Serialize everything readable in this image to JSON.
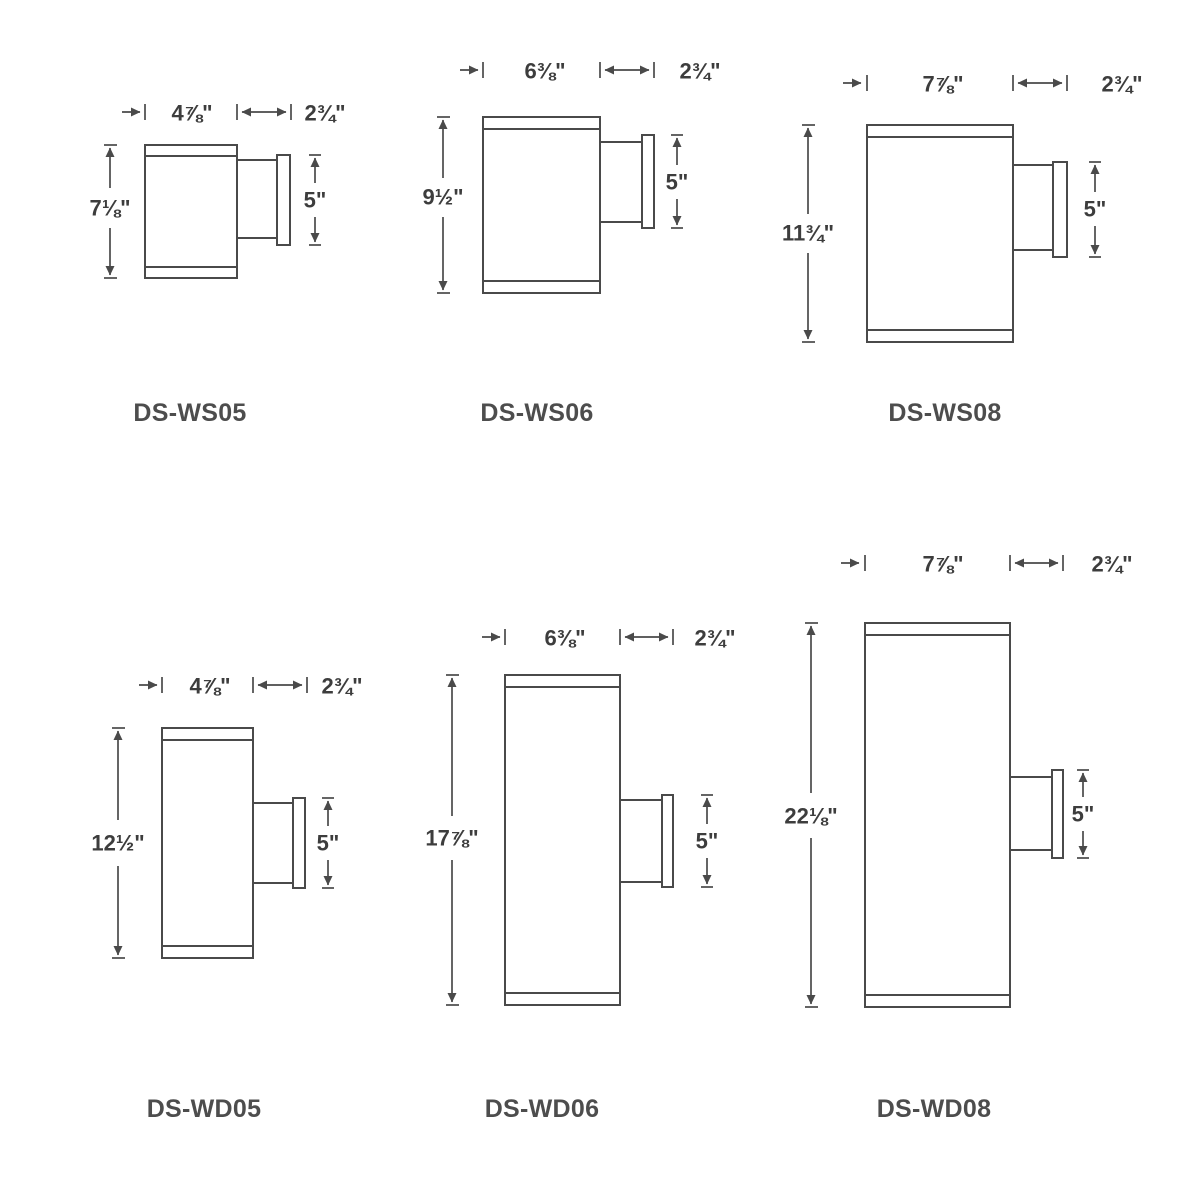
{
  "sheet": {
    "description_rows": [
      "single wall sconces",
      "double wall sconces"
    ],
    "colors": {
      "line": "#4a4a4a",
      "dimension_text": "#3d3d3d",
      "model_text": "#4d4d4d",
      "background": "#ffffff"
    }
  },
  "diagrams": [
    {
      "model": "DS-WS05",
      "width": "4⅞\"",
      "depth": "2¾\"",
      "height": "7⅛\"",
      "backplate": "5\""
    },
    {
      "model": "DS-WS06",
      "width": "6⅜\"",
      "depth": "2¾\"",
      "height": "9½\"",
      "backplate": "5\""
    },
    {
      "model": "DS-WS08",
      "width": "7⅞\"",
      "depth": "2¾\"",
      "height": "11¾\"",
      "backplate": "5\""
    },
    {
      "model": "DS-WD05",
      "width": "4⅞\"",
      "depth": "2¾\"",
      "height": "12½\"",
      "backplate": "5\""
    },
    {
      "model": "DS-WD06",
      "width": "6⅜\"",
      "depth": "2¾\"",
      "height": "17⅞\"",
      "backplate": "5\""
    },
    {
      "model": "DS-WD08",
      "width": "7⅞\"",
      "depth": "2¾\"",
      "height": "22⅛\"",
      "backplate": "5\""
    }
  ]
}
